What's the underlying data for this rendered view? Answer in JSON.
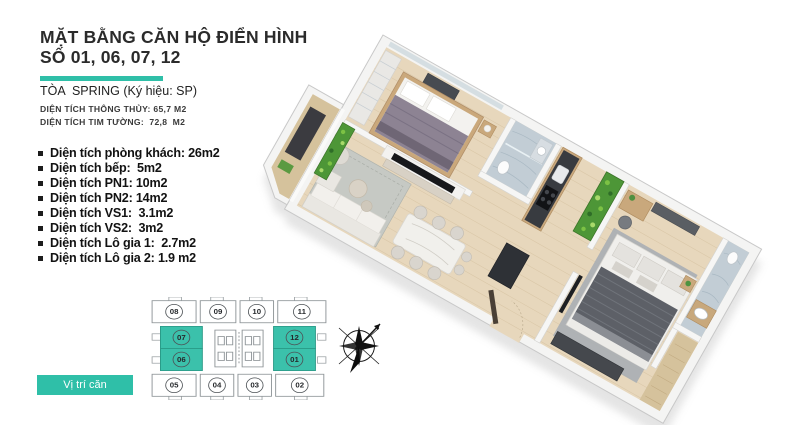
{
  "header": {
    "title_line1": "MẶT BẰNG CĂN HỘ ĐIỂN HÌNH",
    "title_line2": "SỐ 01, 06, 07, 12",
    "tower_line": "TÒA  SPRING (Ký hiệu: SP)",
    "area_line1": "DIỆN TÍCH THÔNG THỦY: 65,7 M2",
    "area_line2": "DIỆN TÍCH TIM TƯỜNG:  72,8  M2"
  },
  "room_areas": [
    "Diện tích phòng khách: 26m2",
    "Diện tích bếp:  5m2",
    "Diện tích PN1: 10m2",
    "Diện tích PN2: 14m2",
    "Diện tích VS1:  3.1m2",
    "Diện tích VS2:  3m2",
    "Diện tích Lô gia 1:  2.7m2",
    "Diện tích Lô gia 2: 1.9 m2"
  ],
  "key_plan": {
    "location_label": "Vị trí căn",
    "units": [
      {
        "label": "08",
        "highlighted": false
      },
      {
        "label": "09",
        "highlighted": false
      },
      {
        "label": "10",
        "highlighted": false
      },
      {
        "label": "11",
        "highlighted": false
      },
      {
        "label": "07",
        "highlighted": true
      },
      {
        "label": "12",
        "highlighted": true
      },
      {
        "label": "06",
        "highlighted": true
      },
      {
        "label": "01",
        "highlighted": true
      }
    ],
    "units_bottom": [
      {
        "label": "05",
        "highlighted": false
      },
      {
        "label": "04",
        "highlighted": false
      },
      {
        "label": "03",
        "highlighted": false
      },
      {
        "label": "02",
        "highlighted": false
      }
    ]
  },
  "colors": {
    "accent_teal": "#2FBFA8",
    "keyplan_teal": "#3BC1AB",
    "wood_floor": "#E7D7BC",
    "balcony_wood": "#D5C29C",
    "green_wall": "#4D9637",
    "marble": "#C2CDD5",
    "bed1": "#8D8393",
    "bed2": "#5D6067",
    "dark_furniture": "#45484D",
    "tv_black": "#17181B"
  }
}
